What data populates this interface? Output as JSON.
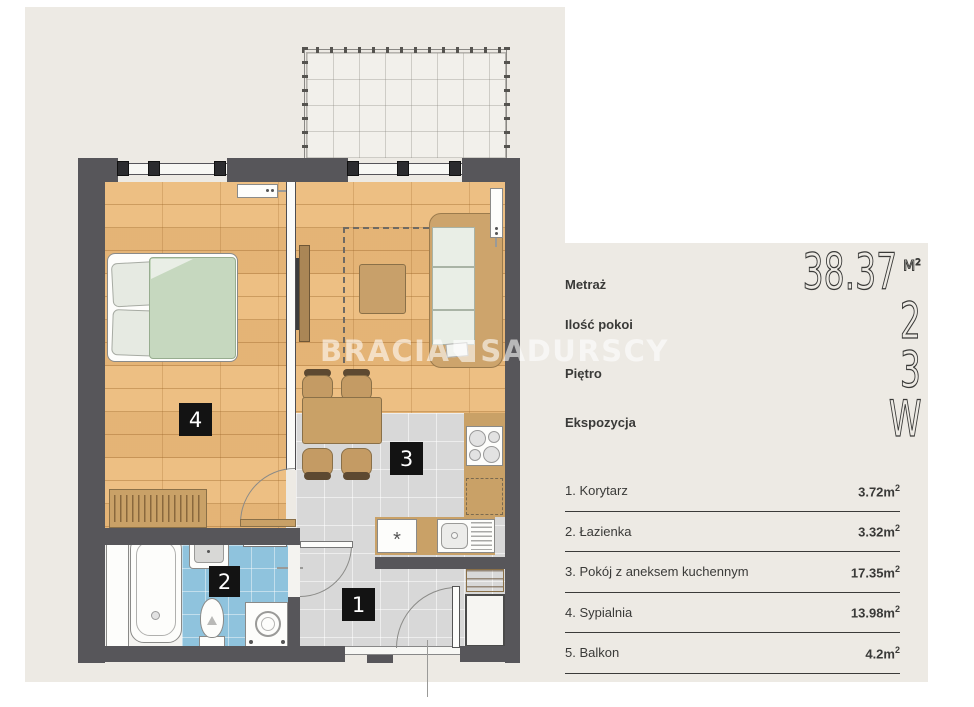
{
  "watermark": {
    "part1": "BRACIA",
    "part2": "SADURSCY"
  },
  "stats": [
    {
      "label": "Metraż",
      "value": "38.37",
      "unit": "M",
      "unit_sup": "2"
    },
    {
      "label": "Ilość pokoi",
      "value": "2"
    },
    {
      "label": "Piętro",
      "value": "3"
    },
    {
      "label": "Ekspozycja",
      "value": "W"
    }
  ],
  "rooms": [
    {
      "name": "1. Korytarz",
      "area": "3.72m",
      "sup": "2"
    },
    {
      "name": "2. Łazienka",
      "area": "3.32m",
      "sup": "2"
    },
    {
      "name": "3. Pokój z aneksem kuchennym",
      "area": "17.35m",
      "sup": "2"
    },
    {
      "name": "4. Sypialnia",
      "area": "13.98m",
      "sup": "2"
    },
    {
      "name": "5. Balkon",
      "area": "4.2m",
      "sup": "2"
    }
  ],
  "plan": {
    "labels": {
      "corridor": "1",
      "bathroom": "2",
      "living": "3",
      "bedroom": "4"
    },
    "dishwasher_symbol": "*",
    "colors": {
      "background": "#edeae4",
      "wall": "#57565a",
      "wood_floor": "#ecba7a",
      "gray_tile": "#d8d8d8",
      "blue_tile": "#8fc3dd",
      "furniture_tan": "#c9a167",
      "label_black": "#131313"
    }
  }
}
